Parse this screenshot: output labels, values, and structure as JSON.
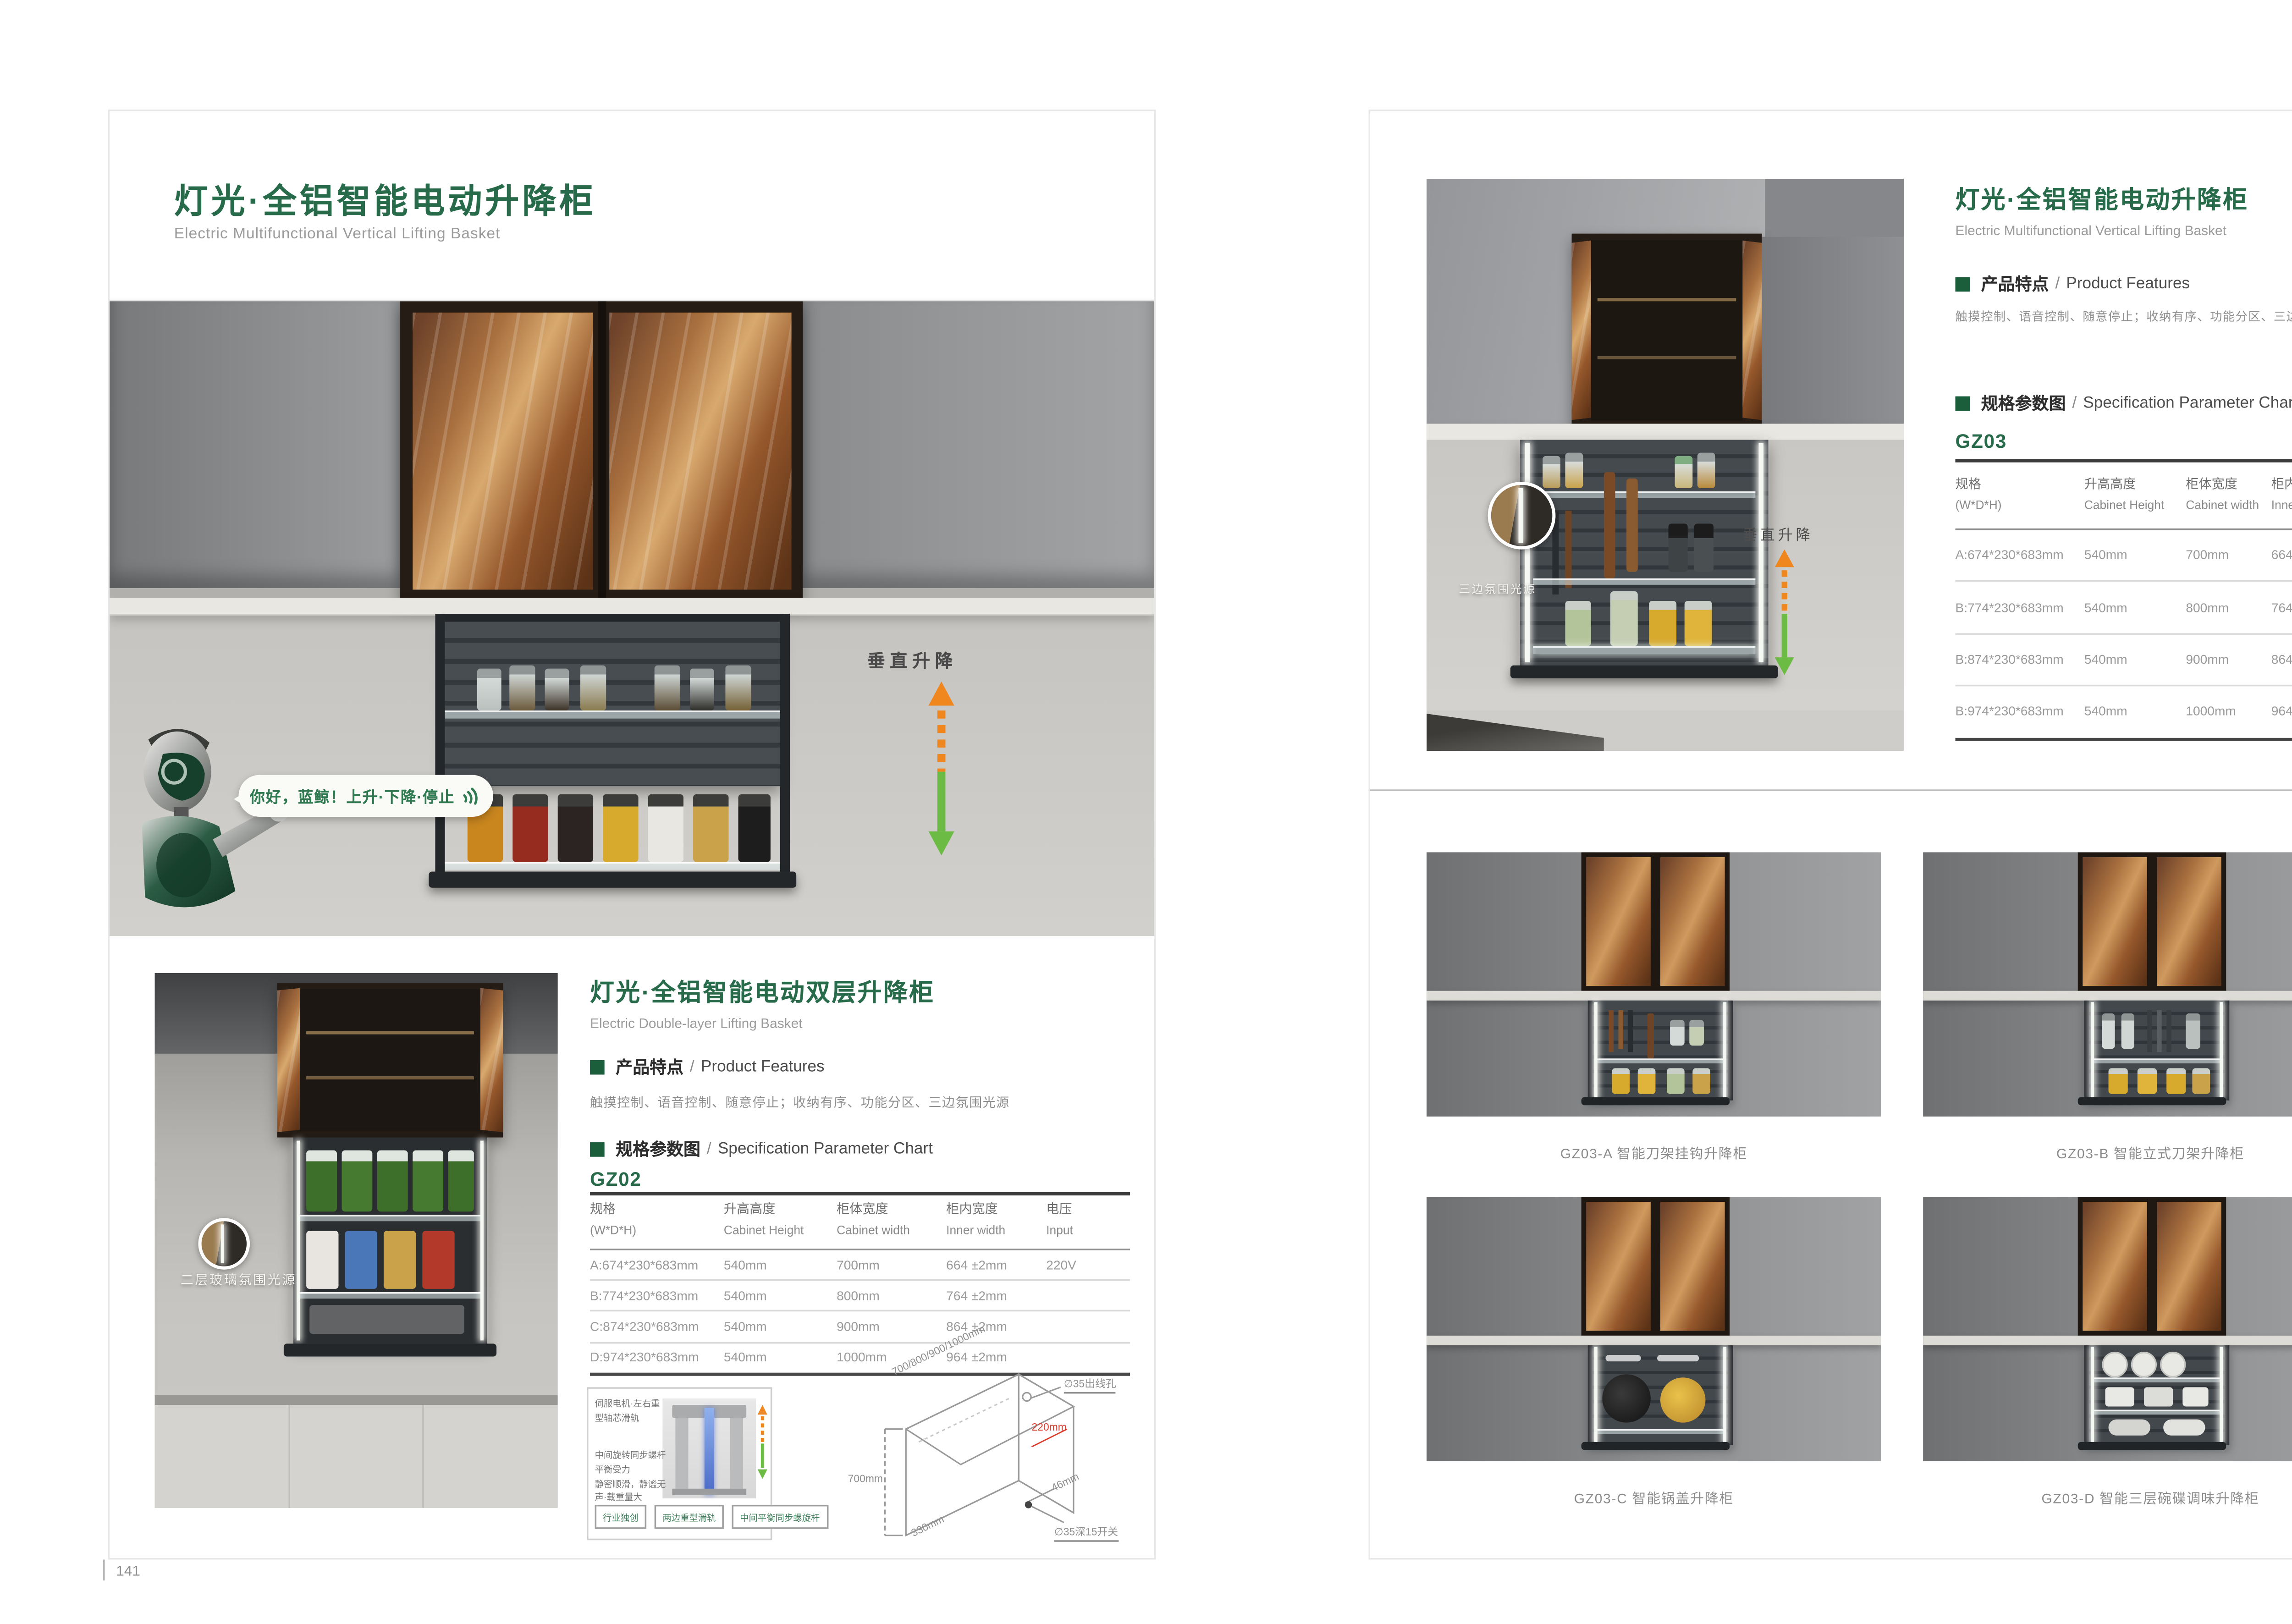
{
  "brand_green": "#276b4a",
  "left_page": {
    "page_number": "141",
    "title_cn": "灯光·全铝智能电动升降柜",
    "title_en": "Electric Multifunctional Vertical Lifting Basket",
    "hero": {
      "bubble_text": "你好，蓝鲸！上升·下降·停止",
      "lift_label": "垂直升降"
    },
    "product2": {
      "callout_label": "二层玻璃氛围光源",
      "title_cn": "灯光·全铝智能电动双层升降柜",
      "title_en": "Electric Double-layer Lifting Basket",
      "features_cn": "产品特点",
      "features_en": "Product Features",
      "features_text": "触摸控制、语音控制、随意停止；收纳有序、功能分区、三边氛围光源",
      "spec_cn": "规格参数图",
      "spec_en": "Specification Parameter Chart",
      "model": "GZ02",
      "table": {
        "columns": [
          {
            "cn": "规格",
            "en": "(W*D*H)"
          },
          {
            "cn": "升高高度",
            "en": "Cabinet Height"
          },
          {
            "cn": "柜体宽度",
            "en": "Cabinet width"
          },
          {
            "cn": "柜内宽度",
            "en": "Inner width"
          },
          {
            "cn": "电压",
            "en": "Input"
          }
        ],
        "rows": [
          [
            "A:674*230*683mm",
            "540mm",
            "700mm",
            "664 ±2mm",
            "220V"
          ],
          [
            "B:774*230*683mm",
            "540mm",
            "800mm",
            "764 ±2mm",
            ""
          ],
          [
            "C:874*230*683mm",
            "540mm",
            "900mm",
            "864 ±2mm",
            ""
          ],
          [
            "D:974*230*683mm",
            "540mm",
            "1000mm",
            "964 ±2mm",
            ""
          ]
        ]
      },
      "diagram": {
        "note1": "伺服电机·左右重型轴芯滑轨",
        "note2": "中间旋转同步螺杆平衡受力",
        "note3": "静密顺滑，静谧无声·载重量大",
        "tags": [
          "行业独创",
          "两边重型滑轨",
          "中间平衡同步螺旋杆"
        ],
        "dim_width": "700/800/900/1000mm",
        "dim_height": "700mm",
        "dim_depth": "330mm",
        "dim_inner": "220mm",
        "dim_gap": "46mm",
        "hole_top": "∅35出线孔",
        "hole_bottom": "∅35深15开关"
      }
    }
  },
  "right_page": {
    "page_number": "142",
    "title_cn": "灯光·全铝智能电动升降柜",
    "title_en": "Electric Multifunctional Vertical Lifting Basket",
    "features_cn": "产品特点",
    "features_en": "Product Features",
    "features_text": "触摸控制、语音控制、随意停止；收纳有序、功能分区、三边氛围光源",
    "spec_cn": "规格参数图",
    "spec_en": "Specification Parameter Chart",
    "model": "GZ03",
    "photo": {
      "callout_label": "三边氛围光源",
      "lift_label": "垂直升降"
    },
    "table": {
      "columns": [
        {
          "cn": "规格",
          "en": "(W*D*H)"
        },
        {
          "cn": "升高高度",
          "en": "Cabinet Height"
        },
        {
          "cn": "柜体宽度",
          "en": "Cabinet width"
        },
        {
          "cn": "柜内宽度",
          "en": "Inner width"
        },
        {
          "cn": "电压",
          "en": "Input"
        }
      ],
      "rows": [
        [
          "A:674*230*683mm",
          "540mm",
          "700mm",
          "664 ±2mm",
          "220V"
        ],
        [
          "B:774*230*683mm",
          "540mm",
          "800mm",
          "764 ±2mm",
          ""
        ],
        [
          "B:874*230*683mm",
          "540mm",
          "900mm",
          "864 ±2mm",
          ""
        ],
        [
          "B:974*230*683mm",
          "540mm",
          "1000mm",
          "964 ±2mm",
          ""
        ]
      ]
    },
    "grid": [
      {
        "caption": "GZ03-A  智能刀架挂钩升降柜"
      },
      {
        "caption": "GZ03-B  智能立式刀架升降柜"
      },
      {
        "caption": "GZ03-C  智能锅盖升降柜"
      },
      {
        "caption": "GZ03-D  智能三层碗碟调味升降柜"
      }
    ]
  }
}
